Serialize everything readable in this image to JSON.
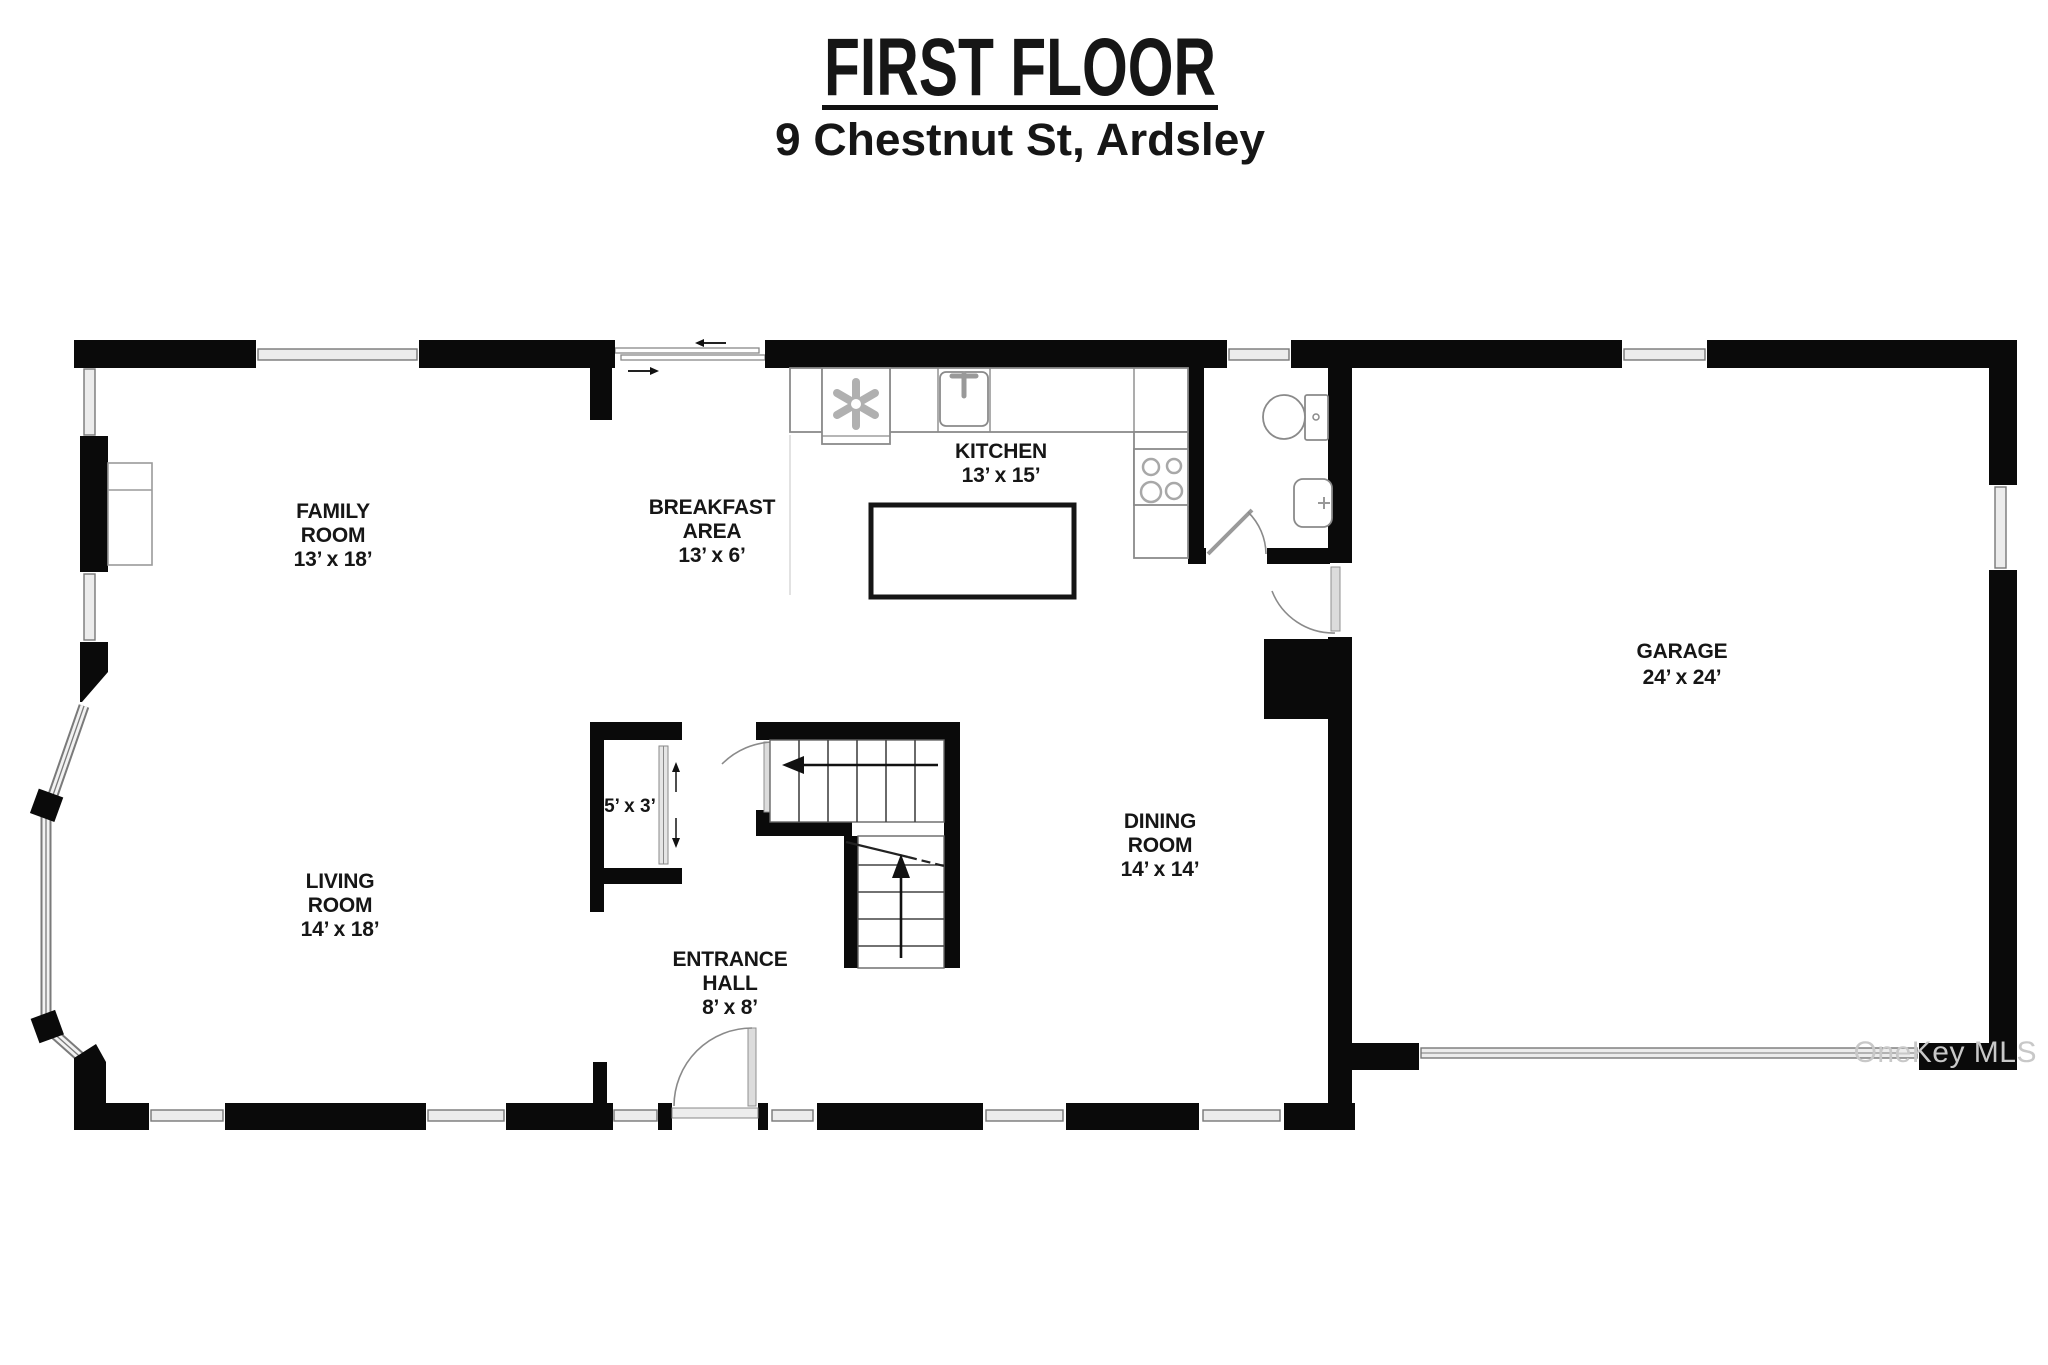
{
  "header": {
    "title": "FIRST FLOOR",
    "subtitle": "9 Chestnut St, Ardsley"
  },
  "watermark": "OneKey MLS",
  "rooms": [
    {
      "id": "family-room",
      "lines": [
        "FAMILY",
        "ROOM",
        "13’ x 18’"
      ]
    },
    {
      "id": "breakfast-area",
      "lines": [
        "BREAKFAST",
        "AREA",
        "13’ x 6’"
      ]
    },
    {
      "id": "kitchen",
      "lines": [
        "KITCHEN",
        "13’ x 15’"
      ]
    },
    {
      "id": "living-room",
      "lines": [
        "LIVING",
        "ROOM",
        "14’ x 18’"
      ]
    },
    {
      "id": "entrance-hall",
      "lines": [
        "ENTRANCE",
        "HALL",
        "8’ x 8’"
      ]
    },
    {
      "id": "dining-room",
      "lines": [
        "DINING",
        "ROOM",
        "14’ x 14’"
      ]
    },
    {
      "id": "garage",
      "lines": [
        "GARAGE",
        "24’ x 24’"
      ]
    },
    {
      "id": "closet",
      "lines": [
        "5’ x 3’"
      ]
    }
  ],
  "fixtures": [
    "range-fan-icon",
    "kitchen-sink-icon",
    "cooktop-burners-icon",
    "kitchen-island",
    "toilet-icon",
    "bathroom-sink-icon",
    "fireplace-block",
    "stairs-up-arrow",
    "stairs-down-arrow",
    "entry-door-swing",
    "sliding-patio-door",
    "closet-bypass-door",
    "bay-window",
    "garage-door",
    "family-room-builtin"
  ],
  "colors": {
    "wall": "#0a0a0a",
    "window_fill": "#ececec",
    "window_stroke": "#777777",
    "fixture_stroke": "#8a8a8a",
    "label": "#161616",
    "watermark": "#c8c8c8",
    "background": "#ffffff"
  }
}
